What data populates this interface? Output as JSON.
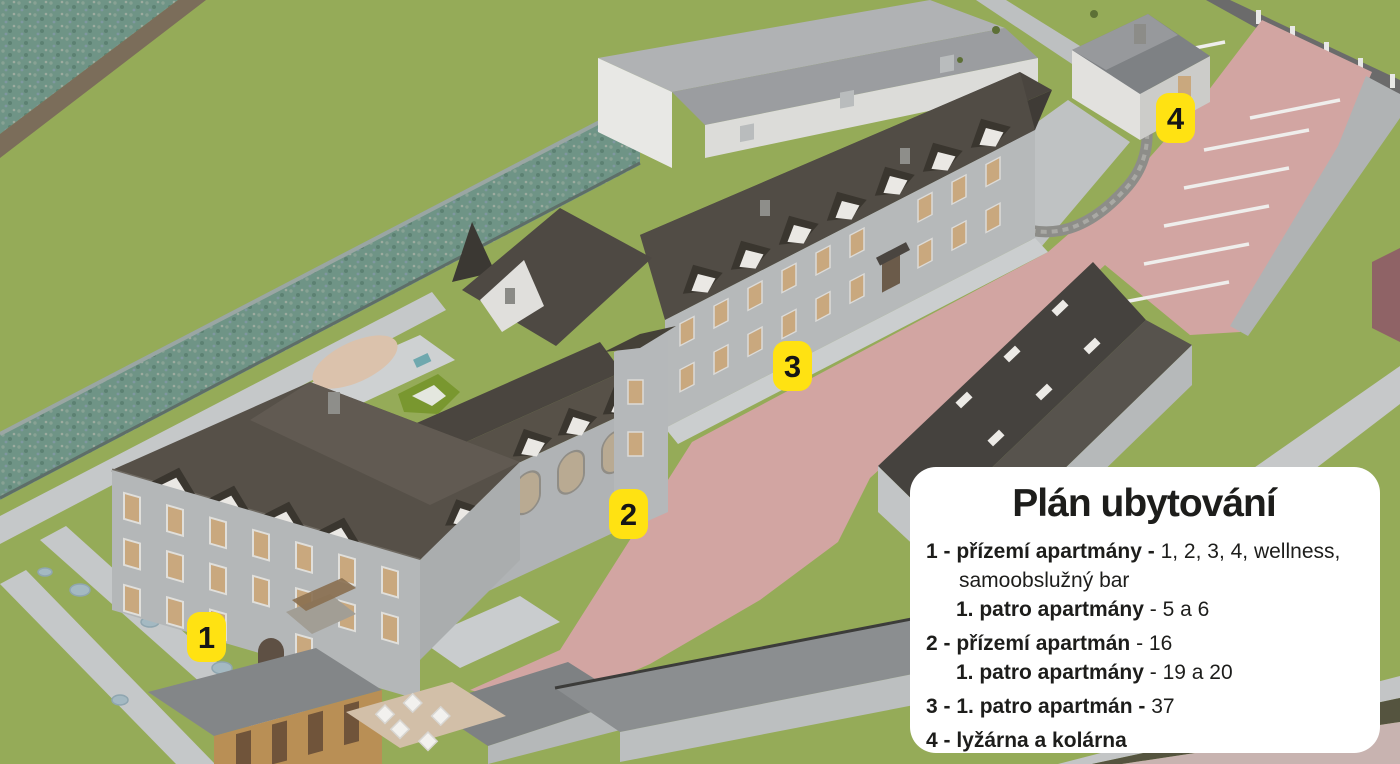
{
  "markers": [
    {
      "label": "1"
    },
    {
      "label": "2"
    },
    {
      "label": "3"
    },
    {
      "label": "4"
    }
  ],
  "legend": {
    "title": "Plán ubytování",
    "rows": [
      {
        "bold": "1 - přízemí apartmány -",
        "regular": " 1, 2, 3, 4, wellness,"
      },
      {
        "bold": "",
        "regular": "samoobslužný bar"
      },
      {
        "bold": "1. patro apartmány",
        "regular": "  - 5 a 6"
      },
      {
        "bold": "2 - přízemí apartmán",
        "regular": " - 16"
      },
      {
        "bold": "1. patro apartmány",
        "regular": "  - 19 a 20"
      },
      {
        "bold": "3 - 1. patro apartmán -",
        "regular": " 37"
      },
      {
        "bold": "4 - lyžárna a kolárna",
        "regular": ""
      }
    ]
  },
  "colors": {
    "marker_bg": "#ffe212",
    "marker_text": "#161616",
    "legend_bg": "#ffffff",
    "legend_text": "#1d1d1b",
    "grass": "#95ab58",
    "road": "#d2a5a2",
    "roof_dark": "#514c45",
    "roof_light": "#9b9da0",
    "wall_light": "#b6b9ba",
    "water_wall": "#6f9486",
    "path_gray": "#c5c8c9"
  }
}
